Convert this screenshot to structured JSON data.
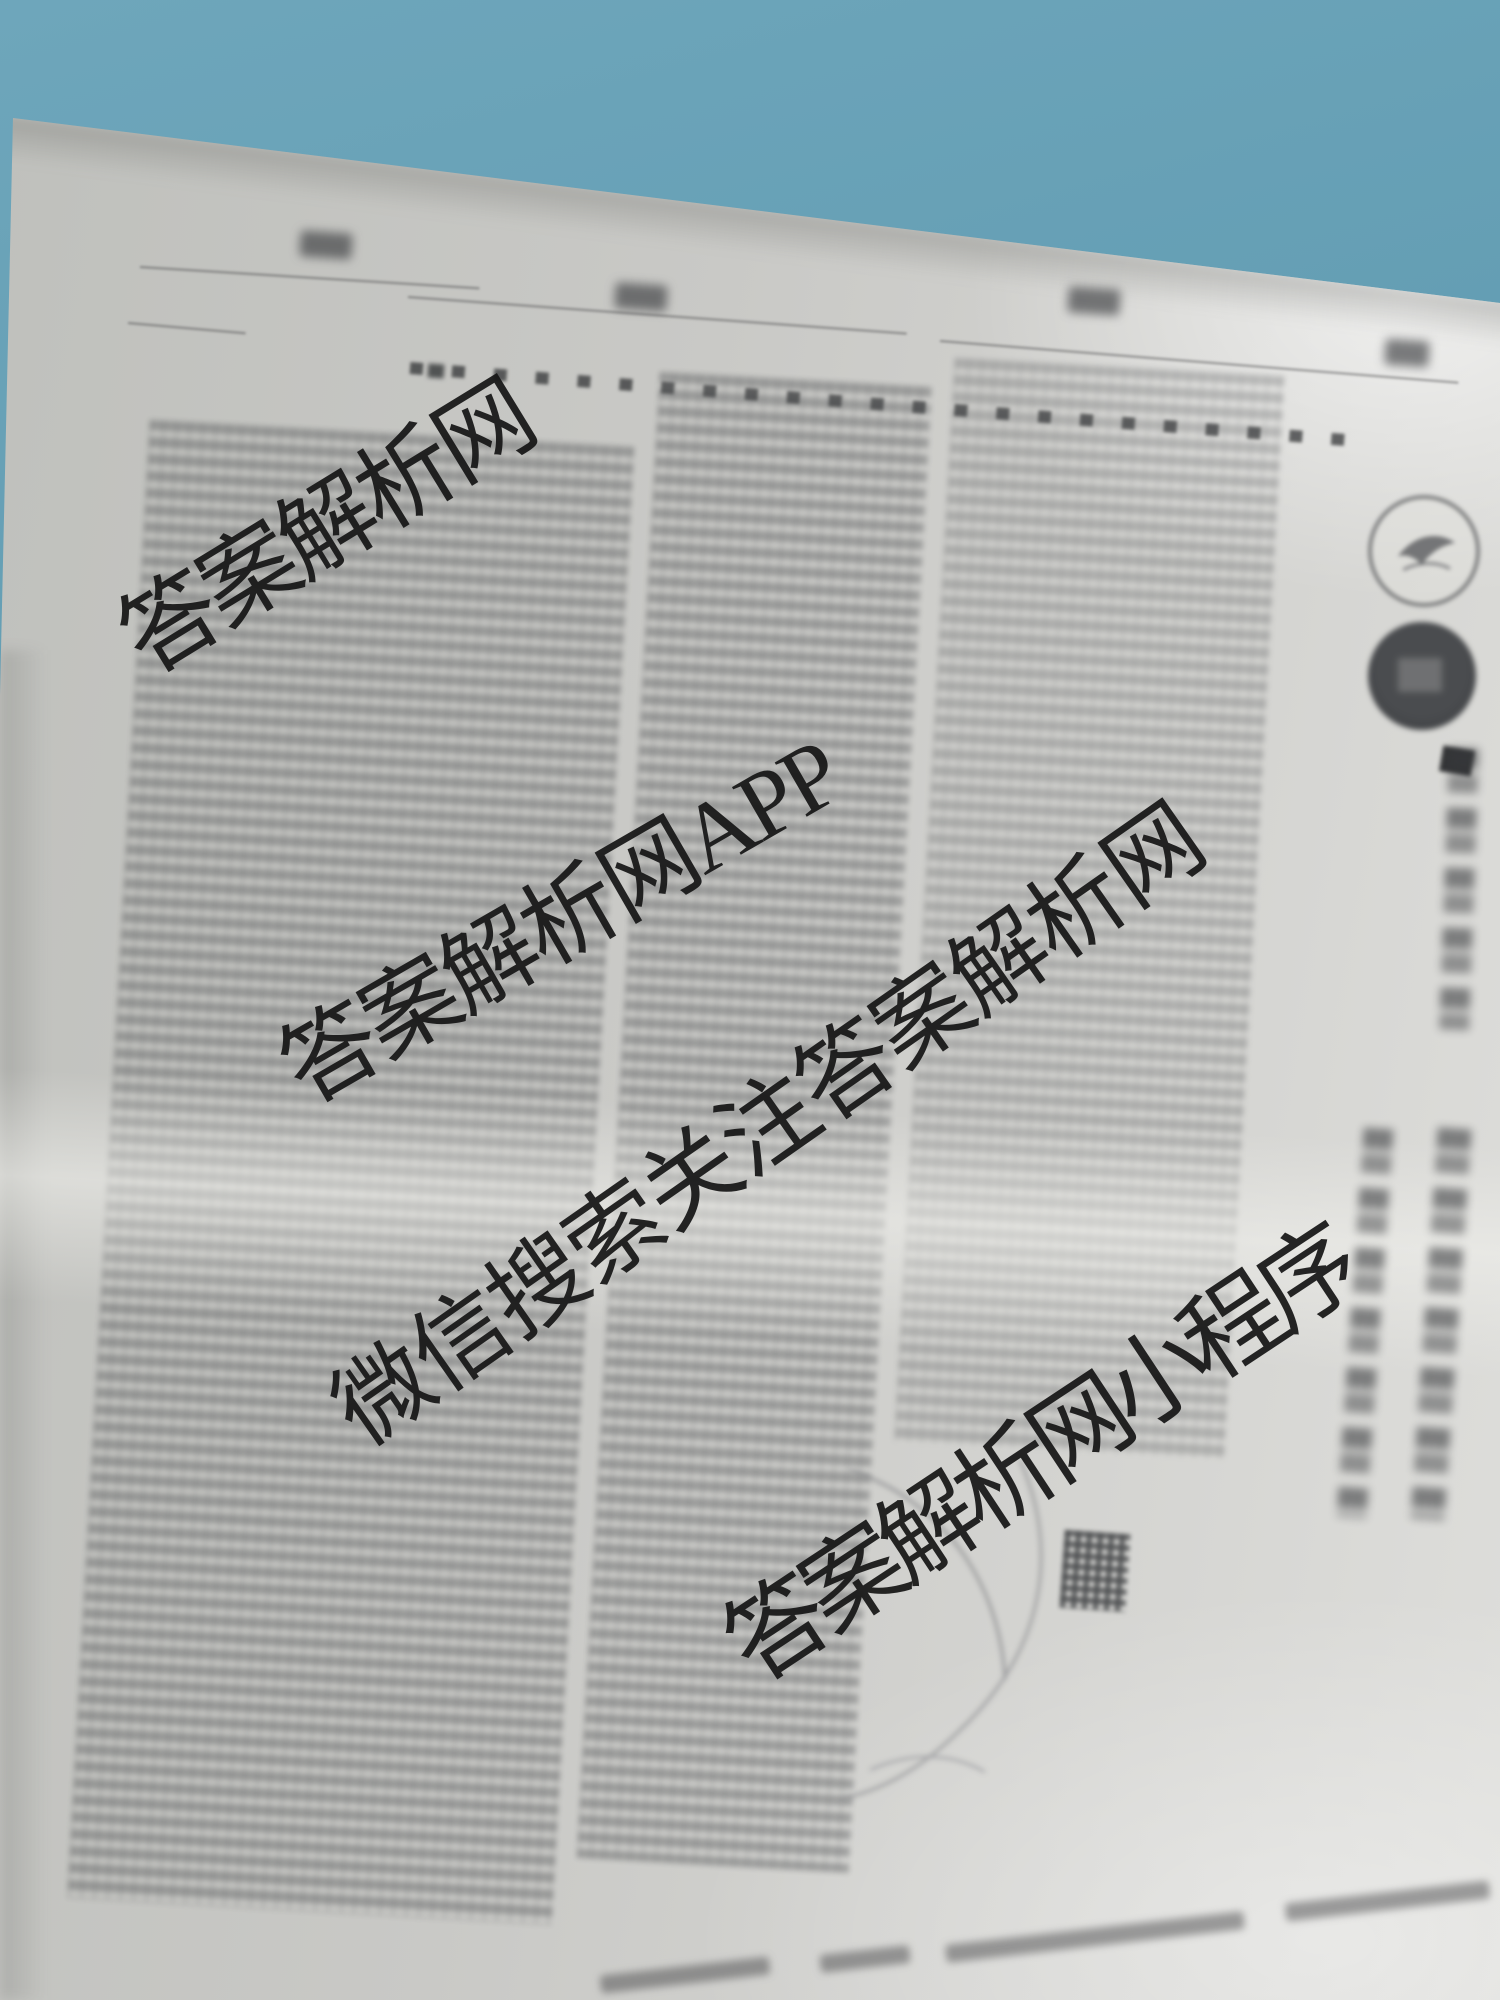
{
  "scene": {
    "description": "Photograph of a blurred, out-of-focus printed exam paper lying on a blue surface, shot at a slight angle, overlaid with large diagonal black watermark text",
    "background_color": "#5f9ab0",
    "paper_color": "#c9c9c6",
    "watermark_color": "#161616",
    "stamp_color": "#3f4143"
  },
  "watermarks": [
    {
      "text": "答案解析网"
    },
    {
      "text": "答案解析网APP"
    },
    {
      "text": "微信搜索关注答案解析网"
    },
    {
      "text": "答案解析网小程序"
    }
  ]
}
